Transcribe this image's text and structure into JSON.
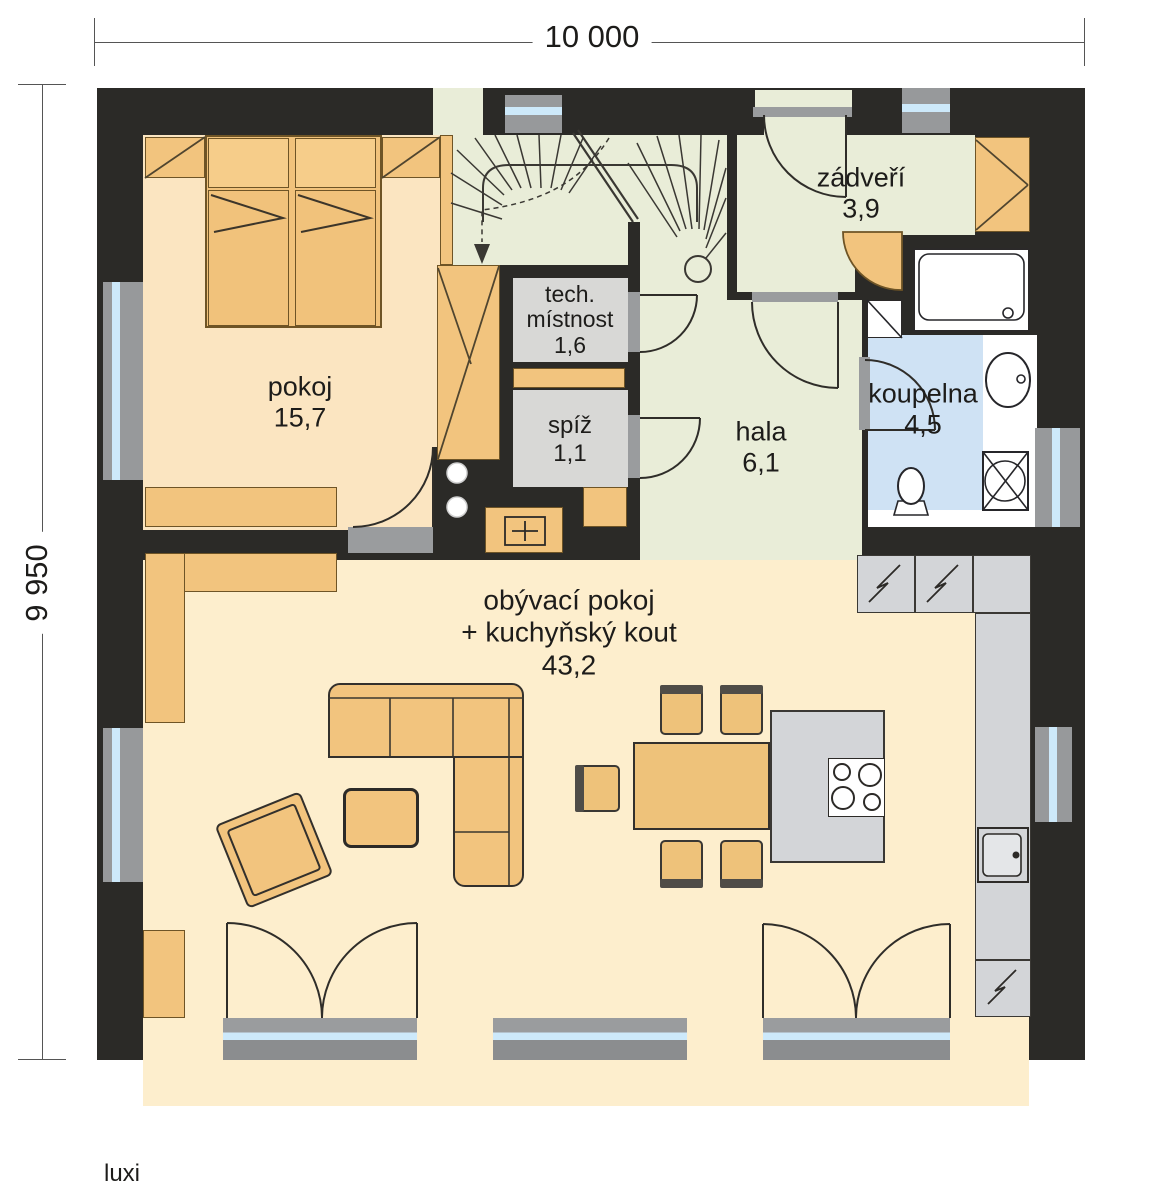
{
  "meta": {
    "brand": "luxi"
  },
  "dimensions": {
    "width_label": "10 000",
    "height_label": "9 950"
  },
  "rooms": {
    "pokoj": {
      "lines": [
        "pokoj",
        "15,7"
      ]
    },
    "tech": {
      "lines": [
        "tech.",
        "místnost",
        "1,6"
      ]
    },
    "spiz": {
      "lines": [
        "spíž",
        "1,1"
      ]
    },
    "hala": {
      "lines": [
        "hala",
        "6,1"
      ]
    },
    "zadveri": {
      "lines": [
        "zádveří",
        "3,9"
      ]
    },
    "koupelna": {
      "lines": [
        "koupelna",
        "4,5"
      ]
    },
    "obyvaci": {
      "lines": [
        "obývací pokoj",
        "+ kuchyňský kout",
        "43,2"
      ]
    }
  },
  "colors": {
    "wall": "#2b2a27",
    "bedroom_floor": "#fbe5c1",
    "living_floor": "#fdeecd",
    "hall_floor": "#e9edd8",
    "utility_floor": "#d8d8d6",
    "bath_floor": "#cfe2f4",
    "furniture": "#f2c47e",
    "counter": "#d3d5d8",
    "window_glass": "#cde9fa"
  }
}
